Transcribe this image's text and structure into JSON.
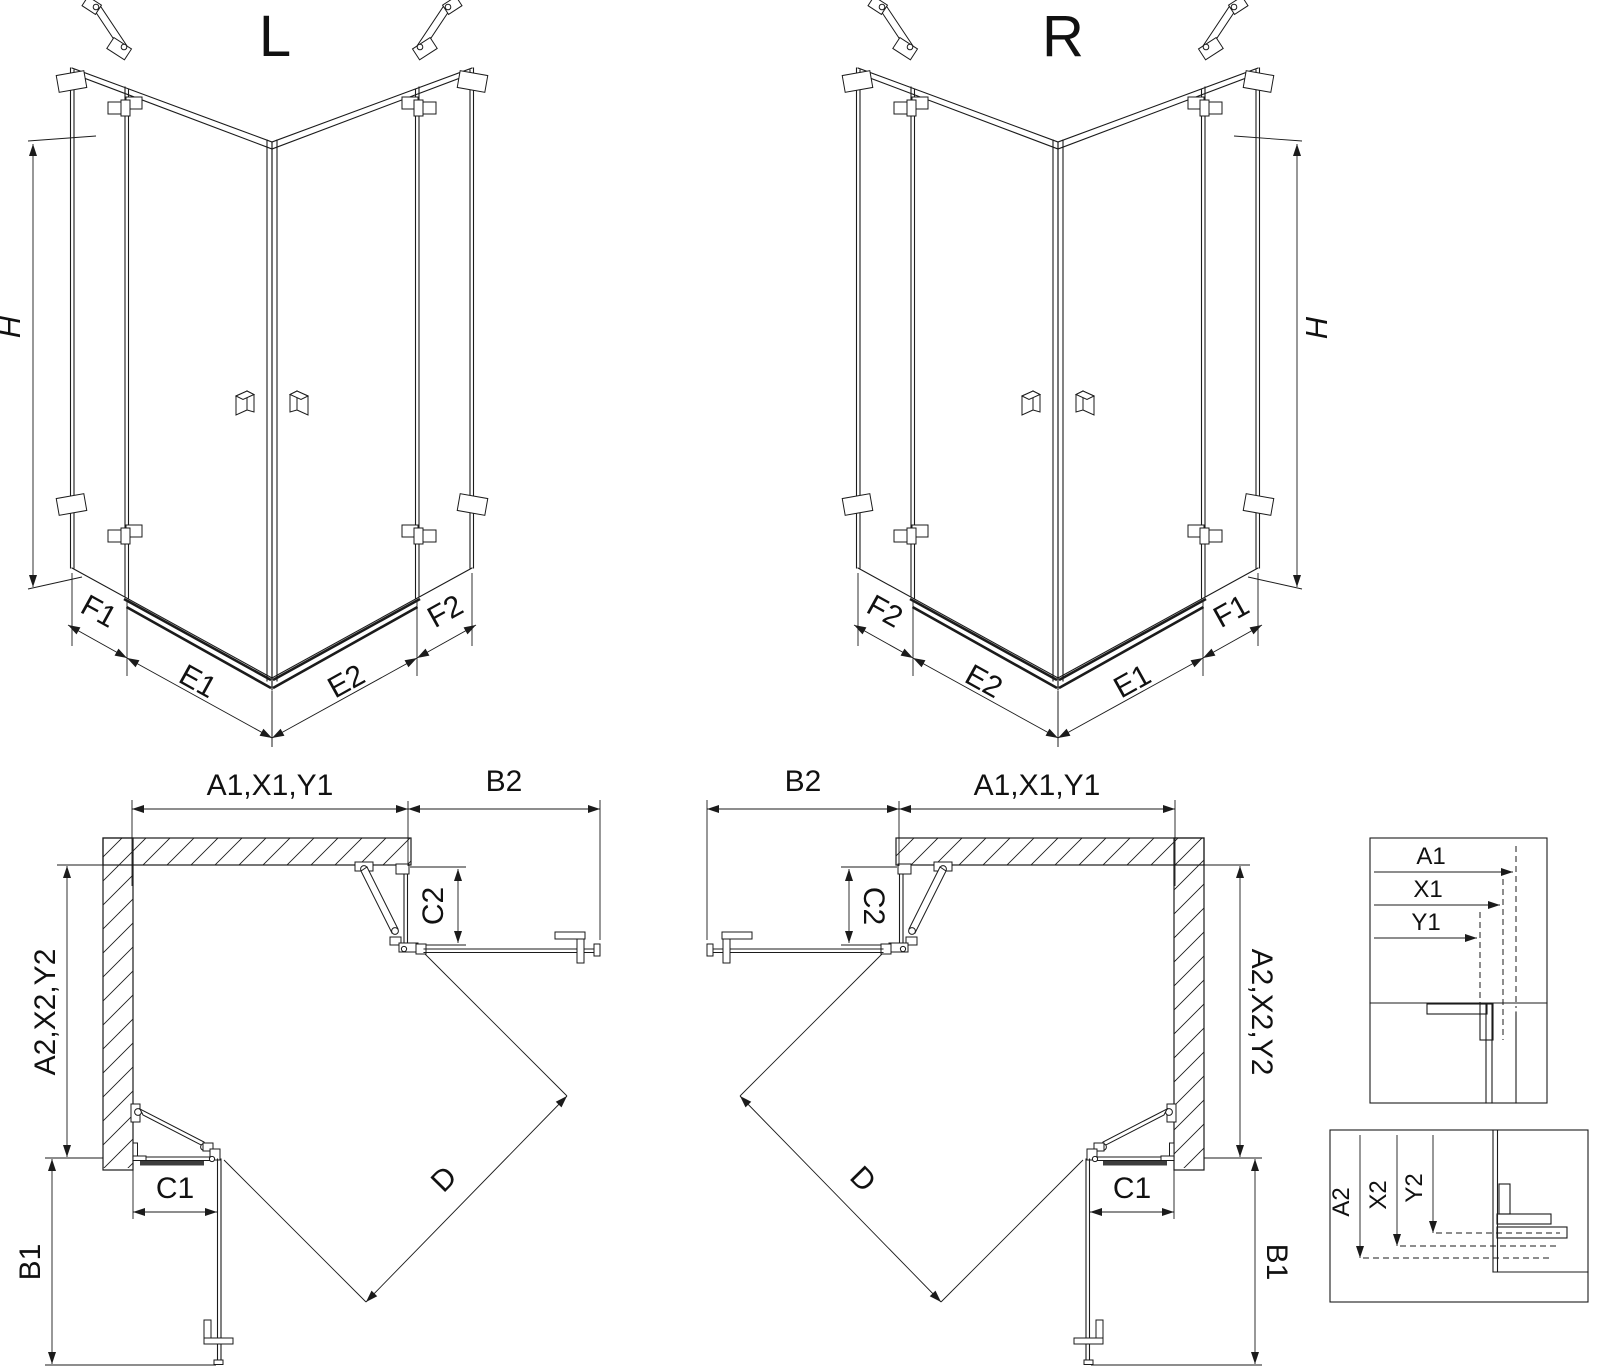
{
  "title": "Corner shower enclosure dimensional drawing",
  "views": {
    "iso_left": {
      "variant_label": "L",
      "height_dim": "H",
      "base_dims": [
        "F1",
        "E1",
        "E2",
        "F2"
      ]
    },
    "iso_right": {
      "variant_label": "R",
      "height_dim": "H",
      "base_dims": [
        "F2",
        "E2",
        "E1",
        "F1"
      ]
    },
    "plan_left": {
      "width_dim": "A1,X1,Y1",
      "return_top_dim": "B2",
      "fixed_top_dim": "C2",
      "depth_dim": "A2,X2,Y2",
      "fixed_bottom_dim": "C1",
      "return_bottom_dim": "B1",
      "diagonal_dim": "D"
    },
    "plan_right": {
      "width_dim": "A1,X1,Y1",
      "return_top_dim": "B2",
      "fixed_top_dim": "C2",
      "depth_dim": "A2,X2,Y2",
      "fixed_bottom_dim": "C1",
      "return_bottom_dim": "B1",
      "diagonal_dim": "D"
    },
    "detail_width": {
      "title_dims": [
        "A1",
        "X1",
        "Y1"
      ]
    },
    "detail_depth": {
      "title_dims": [
        "A2",
        "X2",
        "Y2"
      ]
    }
  },
  "colors": {
    "line": "#1b1b1b",
    "background": "#ffffff"
  }
}
